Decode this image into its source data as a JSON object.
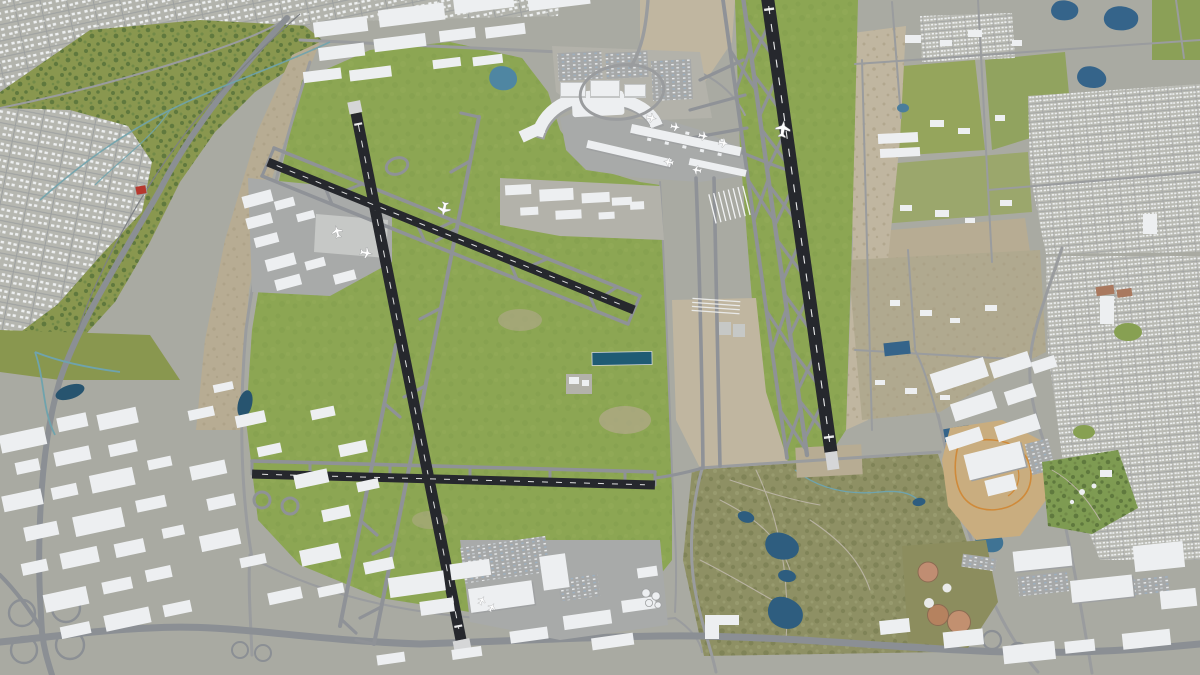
{
  "view": {
    "description": "3D aerial city model render of a large international airport: four dark runways (two crossing diagonals, one near-horizontal, one long parallel runway to the east), curved terminal with two gate piers, parking garages, cargo warehouses, general-aviation hangars, surrounded by residential suburbs, industrial districts, a natural park with creek, a golf park with ponds, water-treatment basins, a dirt-track park and highway cloverleaf interchanges.",
    "type": "3d-aerial-map",
    "visible_text": "none"
  },
  "palette": {
    "urban_ground": "#a9aaa2",
    "suburb_ground": "#b3b4ad",
    "airport_grass": "#8ca653",
    "park_green": "#89974f",
    "olive_park": "#8e9064",
    "dirt_tan": "#c0b6a0",
    "runway_asphalt": "#26282d",
    "taxiway_gray": "#8f9297",
    "road_gray": "#9a9c9e",
    "highway_gray": "#8b8f94",
    "building_white": "#edeff1",
    "building_shadow": "#9fa1a2",
    "water_blue": "#35648a",
    "water_dark_basin": "#1f5b74",
    "creek_teal": "#6fa3ad",
    "tree_green": "#5c753b",
    "red_building": "#b5382e",
    "orange_track": "#cf8a3a",
    "basin_salmon": "#c08d72"
  },
  "features": {
    "runway_count": 4,
    "terminal_piers": 2,
    "aircraft_visible": 12,
    "cloverleaf_interchanges": 2,
    "golf_ponds": 5,
    "treatment_basins": 5,
    "landmarks": [
      "terminal-complex",
      "parking-garages",
      "cargo-warehouses",
      "general-aviation-hangars",
      "fuel-tank-farm",
      "golf-park-with-ponds",
      "water-treatment-plant",
      "dirt-track-park",
      "amusement-green",
      "cloverleaf-interchange",
      "residential-suburbs",
      "industrial-district",
      "natural-park-with-creek",
      "retention-basins"
    ]
  }
}
